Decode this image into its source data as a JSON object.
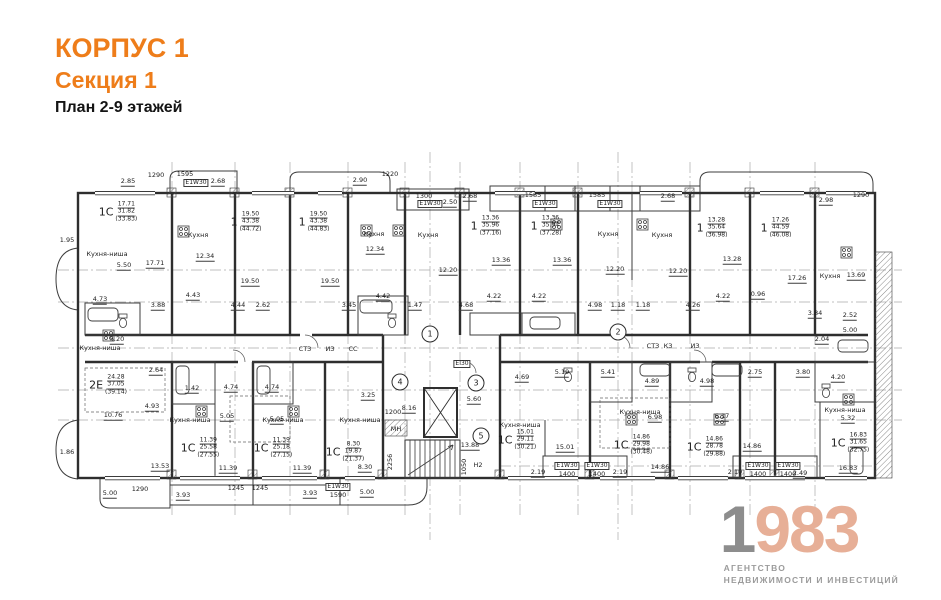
{
  "header": {
    "building": "КОРПУС 1",
    "section": "Секция 1",
    "plan_title": "План 2-9 этажей"
  },
  "logo": {
    "year_first": "1",
    "year_rest": "983",
    "sub_line1": "АГЕНТСТВО",
    "sub_line2": "НЕДВИЖИМОСТИ И ИНВЕСТИЦИЙ"
  },
  "colors": {
    "accent_orange": "#ee7d1a",
    "logo_gray": "#8d8d8d",
    "logo_salmon": "#e7af97",
    "plan_line": "#2e2e2e"
  },
  "plan": {
    "apartments": [
      {
        "p": "1С",
        "l1": "17.71",
        "l2": "31.82",
        "l3": "(33.83)",
        "x": 118,
        "y": 212
      },
      {
        "p": "1",
        "l1": "19.50",
        "l2": "43.38",
        "l3": "(44.72)",
        "x": 246,
        "y": 222
      },
      {
        "p": "1",
        "l1": "19.50",
        "l2": "43.38",
        "l3": "(44.83)",
        "x": 314,
        "y": 222
      },
      {
        "p": "1",
        "l1": "13.36",
        "l2": "35.96",
        "l3": "(37.16)",
        "x": 486,
        "y": 226
      },
      {
        "p": "1",
        "l1": "13.36",
        "l2": "35.94",
        "l3": "(37.28)",
        "x": 546,
        "y": 226
      },
      {
        "p": "1",
        "l1": "13.28",
        "l2": "35.64",
        "l3": "(36.98)",
        "x": 712,
        "y": 228
      },
      {
        "p": "1",
        "l1": "17.26",
        "l2": "44.59",
        "l3": "(46.08)",
        "x": 776,
        "y": 228
      },
      {
        "p": "2Е",
        "l1": "24.28",
        "l2": "37.05",
        "l3": "(39.14)",
        "x": 108,
        "y": 385
      },
      {
        "p": "1С",
        "l1": "11.39",
        "l2": "25.58",
        "l3": "(27.55)",
        "x": 200,
        "y": 448
      },
      {
        "p": "1С",
        "l1": "11.39",
        "l2": "25.18",
        "l3": "(27.15)",
        "x": 273,
        "y": 448
      },
      {
        "p": "1С",
        "l1": "8.30",
        "l2": "19.87",
        "l3": "(21.37)",
        "x": 345,
        "y": 452
      },
      {
        "p": "1С",
        "l1": "15.01",
        "l2": "29.11",
        "l3": "(30.21)",
        "x": 517,
        "y": 440
      },
      {
        "p": "1С",
        "l1": "14.86",
        "l2": "29.98",
        "l3": "(30.48)",
        "x": 633,
        "y": 445
      },
      {
        "p": "1С",
        "l1": "14.86",
        "l2": "28.78",
        "l3": "(29.88)",
        "x": 706,
        "y": 447
      },
      {
        "p": "1С",
        "l1": "16.83",
        "l2": "31.65",
        "l3": "(32.75)",
        "x": 850,
        "y": 443
      }
    ],
    "axes": [
      {
        "n": "1",
        "x": 430,
        "y": 334
      },
      {
        "n": "2",
        "x": 618,
        "y": 332
      },
      {
        "n": "3",
        "x": 476,
        "y": 383
      },
      {
        "n": "4",
        "x": 400,
        "y": 382
      },
      {
        "n": "5",
        "x": 481,
        "y": 436
      }
    ],
    "labels": [
      {
        "t": "1290",
        "x": 156,
        "y": 175
      },
      {
        "t": "1595",
        "x": 185,
        "y": 174
      },
      {
        "t": "Е1W30",
        "x": 196,
        "y": 183,
        "c": "b"
      },
      {
        "t": "2.68",
        "x": 218,
        "y": 182,
        "c": "u"
      },
      {
        "t": "2.85",
        "x": 128,
        "y": 182,
        "c": "u"
      },
      {
        "t": "2.90",
        "x": 360,
        "y": 181,
        "c": "u"
      },
      {
        "t": "1220",
        "x": 390,
        "y": 174
      },
      {
        "t": "1300",
        "x": 424,
        "y": 196
      },
      {
        "t": "Е1W30",
        "x": 430,
        "y": 204,
        "c": "b"
      },
      {
        "t": "2.50",
        "x": 450,
        "y": 203,
        "c": "u"
      },
      {
        "t": "2.68",
        "x": 470,
        "y": 197,
        "c": "u"
      },
      {
        "t": "1585",
        "x": 533,
        "y": 195
      },
      {
        "t": "1585",
        "x": 597,
        "y": 195
      },
      {
        "t": "Е1W30",
        "x": 545,
        "y": 204,
        "c": "b"
      },
      {
        "t": "Е1W30",
        "x": 610,
        "y": 204,
        "c": "b"
      },
      {
        "t": "2.68",
        "x": 668,
        "y": 197,
        "c": "u"
      },
      {
        "t": "2.98",
        "x": 826,
        "y": 201,
        "c": "u"
      },
      {
        "t": "1290",
        "x": 861,
        "y": 195
      },
      {
        "t": "1.95",
        "x": 67,
        "y": 240
      },
      {
        "t": "1.86",
        "x": 67,
        "y": 452
      },
      {
        "t": "Кухня-ниша",
        "x": 107,
        "y": 254
      },
      {
        "t": "5.50",
        "x": 124,
        "y": 266,
        "c": "u"
      },
      {
        "t": "17.71",
        "x": 155,
        "y": 264,
        "c": "u"
      },
      {
        "t": "4.73",
        "x": 100,
        "y": 300,
        "c": "u"
      },
      {
        "t": "3.88",
        "x": 158,
        "y": 306,
        "c": "u"
      },
      {
        "t": "4.43",
        "x": 193,
        "y": 296,
        "c": "u"
      },
      {
        "t": "12.34",
        "x": 205,
        "y": 257,
        "c": "u"
      },
      {
        "t": "Кухня",
        "x": 198,
        "y": 235
      },
      {
        "t": "19.50",
        "x": 250,
        "y": 282,
        "c": "u"
      },
      {
        "t": "19.50",
        "x": 330,
        "y": 282,
        "c": "u"
      },
      {
        "t": "4.44",
        "x": 238,
        "y": 306,
        "c": "u"
      },
      {
        "t": "2.62",
        "x": 263,
        "y": 306,
        "c": "u"
      },
      {
        "t": "3.45",
        "x": 349,
        "y": 306,
        "c": "u"
      },
      {
        "t": "Кухня",
        "x": 374,
        "y": 234
      },
      {
        "t": "Кухня",
        "x": 428,
        "y": 235
      },
      {
        "t": "12.34",
        "x": 375,
        "y": 250,
        "c": "u"
      },
      {
        "t": "4.42",
        "x": 383,
        "y": 297,
        "c": "u"
      },
      {
        "t": "1.47",
        "x": 415,
        "y": 306,
        "c": "u"
      },
      {
        "t": "12.20",
        "x": 448,
        "y": 271,
        "c": "u"
      },
      {
        "t": "13.36",
        "x": 501,
        "y": 261,
        "c": "u"
      },
      {
        "t": "13.36",
        "x": 562,
        "y": 261,
        "c": "u"
      },
      {
        "t": "4.22",
        "x": 494,
        "y": 297,
        "c": "u"
      },
      {
        "t": "4.22",
        "x": 539,
        "y": 297,
        "c": "u"
      },
      {
        "t": "4.68",
        "x": 466,
        "y": 306,
        "c": "u"
      },
      {
        "t": "4.98",
        "x": 595,
        "y": 306,
        "c": "u"
      },
      {
        "t": "1.18",
        "x": 618,
        "y": 306,
        "c": "u"
      },
      {
        "t": "1.18",
        "x": 643,
        "y": 306,
        "c": "u"
      },
      {
        "t": "12.20",
        "x": 615,
        "y": 270,
        "c": "u"
      },
      {
        "t": "12.20",
        "x": 678,
        "y": 272,
        "c": "u"
      },
      {
        "t": "Кухня",
        "x": 608,
        "y": 234
      },
      {
        "t": "Кухня",
        "x": 662,
        "y": 235
      },
      {
        "t": "13.28",
        "x": 732,
        "y": 260,
        "c": "u"
      },
      {
        "t": "17.26",
        "x": 797,
        "y": 279,
        "c": "u"
      },
      {
        "t": "4.26",
        "x": 693,
        "y": 306,
        "c": "u"
      },
      {
        "t": "4.22",
        "x": 723,
        "y": 297,
        "c": "u"
      },
      {
        "t": "0.96",
        "x": 758,
        "y": 295,
        "c": "u"
      },
      {
        "t": "Кухня",
        "x": 830,
        "y": 276
      },
      {
        "t": "13.69",
        "x": 856,
        "y": 276,
        "c": "u"
      },
      {
        "t": "3.84",
        "x": 815,
        "y": 314,
        "c": "u"
      },
      {
        "t": "2.52",
        "x": 850,
        "y": 316,
        "c": "u"
      },
      {
        "t": "5.00",
        "x": 850,
        "y": 331,
        "c": "u"
      },
      {
        "t": "2.04",
        "x": 822,
        "y": 340,
        "c": "u"
      },
      {
        "t": "3.80",
        "x": 803,
        "y": 373,
        "c": "u"
      },
      {
        "t": "4.20",
        "x": 838,
        "y": 378,
        "c": "u"
      },
      {
        "t": "СТЗ",
        "x": 305,
        "y": 349
      },
      {
        "t": "ИЗ",
        "x": 330,
        "y": 349
      },
      {
        "t": "СС",
        "x": 353,
        "y": 349
      },
      {
        "t": "СТЗ",
        "x": 653,
        "y": 346
      },
      {
        "t": "КЗ",
        "x": 668,
        "y": 346
      },
      {
        "t": "ИЗ",
        "x": 695,
        "y": 346
      },
      {
        "t": "ЕІ30",
        "x": 462,
        "y": 364,
        "c": "b"
      },
      {
        "t": "МН",
        "x": 396,
        "y": 429
      },
      {
        "t": "Н2",
        "x": 478,
        "y": 465
      },
      {
        "t": "1050",
        "x": 464,
        "y": 467,
        "c": "v"
      },
      {
        "t": "2256",
        "x": 390,
        "y": 462,
        "c": "v"
      },
      {
        "t": "1200",
        "x": 393,
        "y": 412
      },
      {
        "t": "8.16",
        "x": 409,
        "y": 409,
        "c": "u"
      },
      {
        "t": "5.60",
        "x": 474,
        "y": 400,
        "c": "u"
      },
      {
        "t": "13.88",
        "x": 470,
        "y": 446,
        "c": "u"
      },
      {
        "t": "3.25",
        "x": 368,
        "y": 396,
        "c": "u"
      },
      {
        "t": "Кухня-ниша",
        "x": 100,
        "y": 348
      },
      {
        "t": "5.20",
        "x": 117,
        "y": 340,
        "c": "u"
      },
      {
        "t": "2.64",
        "x": 156,
        "y": 371,
        "c": "u"
      },
      {
        "t": "4.93",
        "x": 152,
        "y": 407,
        "c": "u"
      },
      {
        "t": "10.76",
        "x": 113,
        "y": 416,
        "c": "u"
      },
      {
        "t": "1.42",
        "x": 192,
        "y": 389,
        "c": "u"
      },
      {
        "t": "4.74",
        "x": 231,
        "y": 388,
        "c": "u"
      },
      {
        "t": "4.74",
        "x": 272,
        "y": 388,
        "c": "u"
      },
      {
        "t": "5.05",
        "x": 227,
        "y": 417,
        "c": "u"
      },
      {
        "t": "5.05",
        "x": 277,
        "y": 420,
        "c": "u"
      },
      {
        "t": "Кухня-ниша",
        "x": 190,
        "y": 420
      },
      {
        "t": "Кухня-ниша",
        "x": 283,
        "y": 420
      },
      {
        "t": "Кухня-ниша",
        "x": 360,
        "y": 420
      },
      {
        "t": "13.53",
        "x": 160,
        "y": 467,
        "c": "u"
      },
      {
        "t": "11.39",
        "x": 228,
        "y": 469,
        "c": "u"
      },
      {
        "t": "11.39",
        "x": 302,
        "y": 469,
        "c": "u"
      },
      {
        "t": "8.30",
        "x": 365,
        "y": 468,
        "c": "u"
      },
      {
        "t": "5.19",
        "x": 562,
        "y": 373,
        "c": "u"
      },
      {
        "t": "5.41",
        "x": 608,
        "y": 373,
        "c": "u"
      },
      {
        "t": "4.89",
        "x": 652,
        "y": 382,
        "c": "u"
      },
      {
        "t": "4.98",
        "x": 707,
        "y": 382,
        "c": "u"
      },
      {
        "t": "2.75",
        "x": 755,
        "y": 373,
        "c": "u"
      },
      {
        "t": "4.69",
        "x": 522,
        "y": 378,
        "c": "u"
      },
      {
        "t": "Кухня-ниша",
        "x": 520,
        "y": 425
      },
      {
        "t": "6.98",
        "x": 655,
        "y": 418,
        "c": "u"
      },
      {
        "t": "6.17",
        "x": 722,
        "y": 417,
        "c": "u"
      },
      {
        "t": "Кухня-ниша",
        "x": 640,
        "y": 412
      },
      {
        "t": "Кухня-ниша",
        "x": 845,
        "y": 410
      },
      {
        "t": "5.32",
        "x": 848,
        "y": 419,
        "c": "u"
      },
      {
        "t": "15.01",
        "x": 565,
        "y": 448,
        "c": "u"
      },
      {
        "t": "14.86",
        "x": 660,
        "y": 468,
        "c": "u"
      },
      {
        "t": "14.86",
        "x": 752,
        "y": 447,
        "c": "u"
      },
      {
        "t": "16.83",
        "x": 848,
        "y": 469,
        "c": "u"
      },
      {
        "t": "2.19",
        "x": 538,
        "y": 473,
        "c": "u"
      },
      {
        "t": "2.19",
        "x": 620,
        "y": 473,
        "c": "u"
      },
      {
        "t": "2.19",
        "x": 735,
        "y": 473,
        "c": "u"
      },
      {
        "t": "2.49",
        "x": 800,
        "y": 474,
        "c": "u"
      },
      {
        "t": "Е1W30",
        "x": 567,
        "y": 466,
        "c": "b"
      },
      {
        "t": "1400",
        "x": 567,
        "y": 474
      },
      {
        "t": "Е1W30",
        "x": 597,
        "y": 466,
        "c": "b"
      },
      {
        "t": "1400",
        "x": 597,
        "y": 474
      },
      {
        "t": "Е1W30",
        "x": 758,
        "y": 466,
        "c": "b"
      },
      {
        "t": "1400",
        "x": 758,
        "y": 474
      },
      {
        "t": "Е1W30",
        "x": 788,
        "y": 466,
        "c": "b"
      },
      {
        "t": "1400",
        "x": 788,
        "y": 474
      },
      {
        "t": "5.00",
        "x": 110,
        "y": 494,
        "c": "u"
      },
      {
        "t": "1290",
        "x": 140,
        "y": 489
      },
      {
        "t": "3.93",
        "x": 183,
        "y": 496,
        "c": "u"
      },
      {
        "t": "1245",
        "x": 236,
        "y": 488
      },
      {
        "t": "1245",
        "x": 260,
        "y": 488
      },
      {
        "t": "3.93",
        "x": 310,
        "y": 494,
        "c": "u"
      },
      {
        "t": "Е1W30",
        "x": 338,
        "y": 487,
        "c": "b"
      },
      {
        "t": "1590",
        "x": 338,
        "y": 495
      },
      {
        "t": "5.00",
        "x": 367,
        "y": 493,
        "c": "u"
      }
    ]
  }
}
